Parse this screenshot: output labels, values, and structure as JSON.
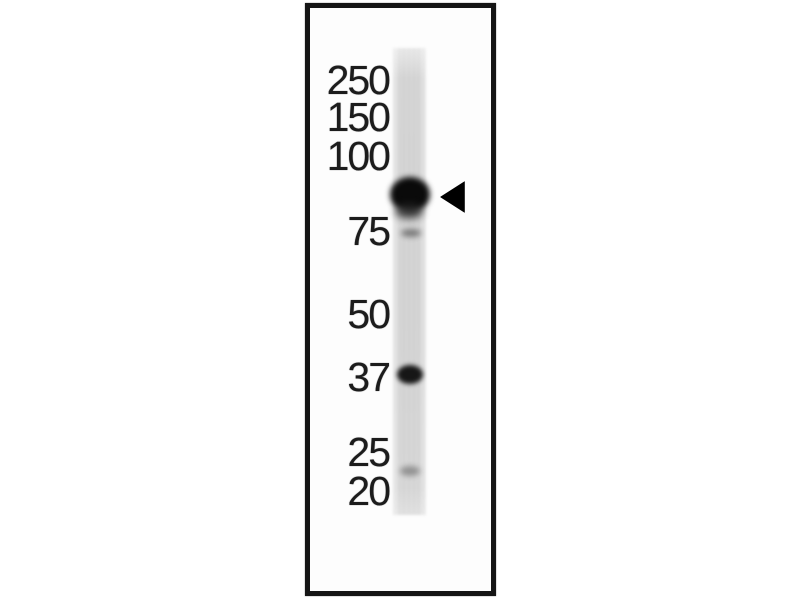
{
  "figure": {
    "kind": "western-blot",
    "description": "Western blot, single gel lane with molecular weight marker labels (kDa) and an arrowhead indicating the specific band between the 100 and 75 kDa markers",
    "colors": {
      "background": "#ffffff",
      "panel_border": "#151515",
      "panel_background": "#fdfdfd",
      "lane_gray": "#d5d5d5",
      "band_dark": "#0a0a0a",
      "label_text": "#1c1c1c",
      "arrow_black": "#000000"
    },
    "markers": [
      {
        "label": "250",
        "unit": "kDa",
        "y": 81
      },
      {
        "label": "150",
        "unit": "kDa",
        "y": 118
      },
      {
        "label": "100",
        "unit": "kDa",
        "y": 157
      },
      {
        "label": "75",
        "unit": "kDa",
        "y": 232
      },
      {
        "label": "50",
        "unit": "kDa",
        "y": 315
      },
      {
        "label": "37",
        "unit": "kDa",
        "y": 378
      },
      {
        "label": "25",
        "unit": "kDa",
        "y": 453
      },
      {
        "label": "20",
        "unit": "kDa",
        "y": 492
      }
    ],
    "lane": {
      "x": 393,
      "y": 48,
      "width": 33,
      "height": 467
    },
    "bands": [
      {
        "approx_kda": "~90",
        "intensity": "strong",
        "cx": 410,
        "cy": 194,
        "w": 40,
        "h": 35,
        "color": "#0a0a0a",
        "blur": 3,
        "opacity": 1
      },
      {
        "approx_kda": "~85",
        "intensity": "medium smear below main band",
        "cx": 409,
        "cy": 211,
        "w": 28,
        "h": 15,
        "color": "#2b2b2b",
        "blur": 4,
        "opacity": 0.8
      },
      {
        "approx_kda": "75",
        "intensity": "faint",
        "cx": 411,
        "cy": 233,
        "w": 20,
        "h": 8,
        "color": "#707070",
        "blur": 3,
        "opacity": 0.9
      },
      {
        "approx_kda": "37",
        "intensity": "medium",
        "cx": 410,
        "cy": 374,
        "w": 26,
        "h": 19,
        "color": "#161616",
        "blur": 2.5,
        "opacity": 1
      },
      {
        "approx_kda": "~22",
        "intensity": "faint",
        "cx": 410,
        "cy": 471,
        "w": 20,
        "h": 10,
        "color": "#8a8a8a",
        "blur": 3,
        "opacity": 0.9
      }
    ],
    "arrow": {
      "points_to": "strong band at ~90 kDa",
      "tip_x": 440,
      "tip_y": 197,
      "length": 25,
      "half_height": 16,
      "color": "#000000"
    }
  }
}
